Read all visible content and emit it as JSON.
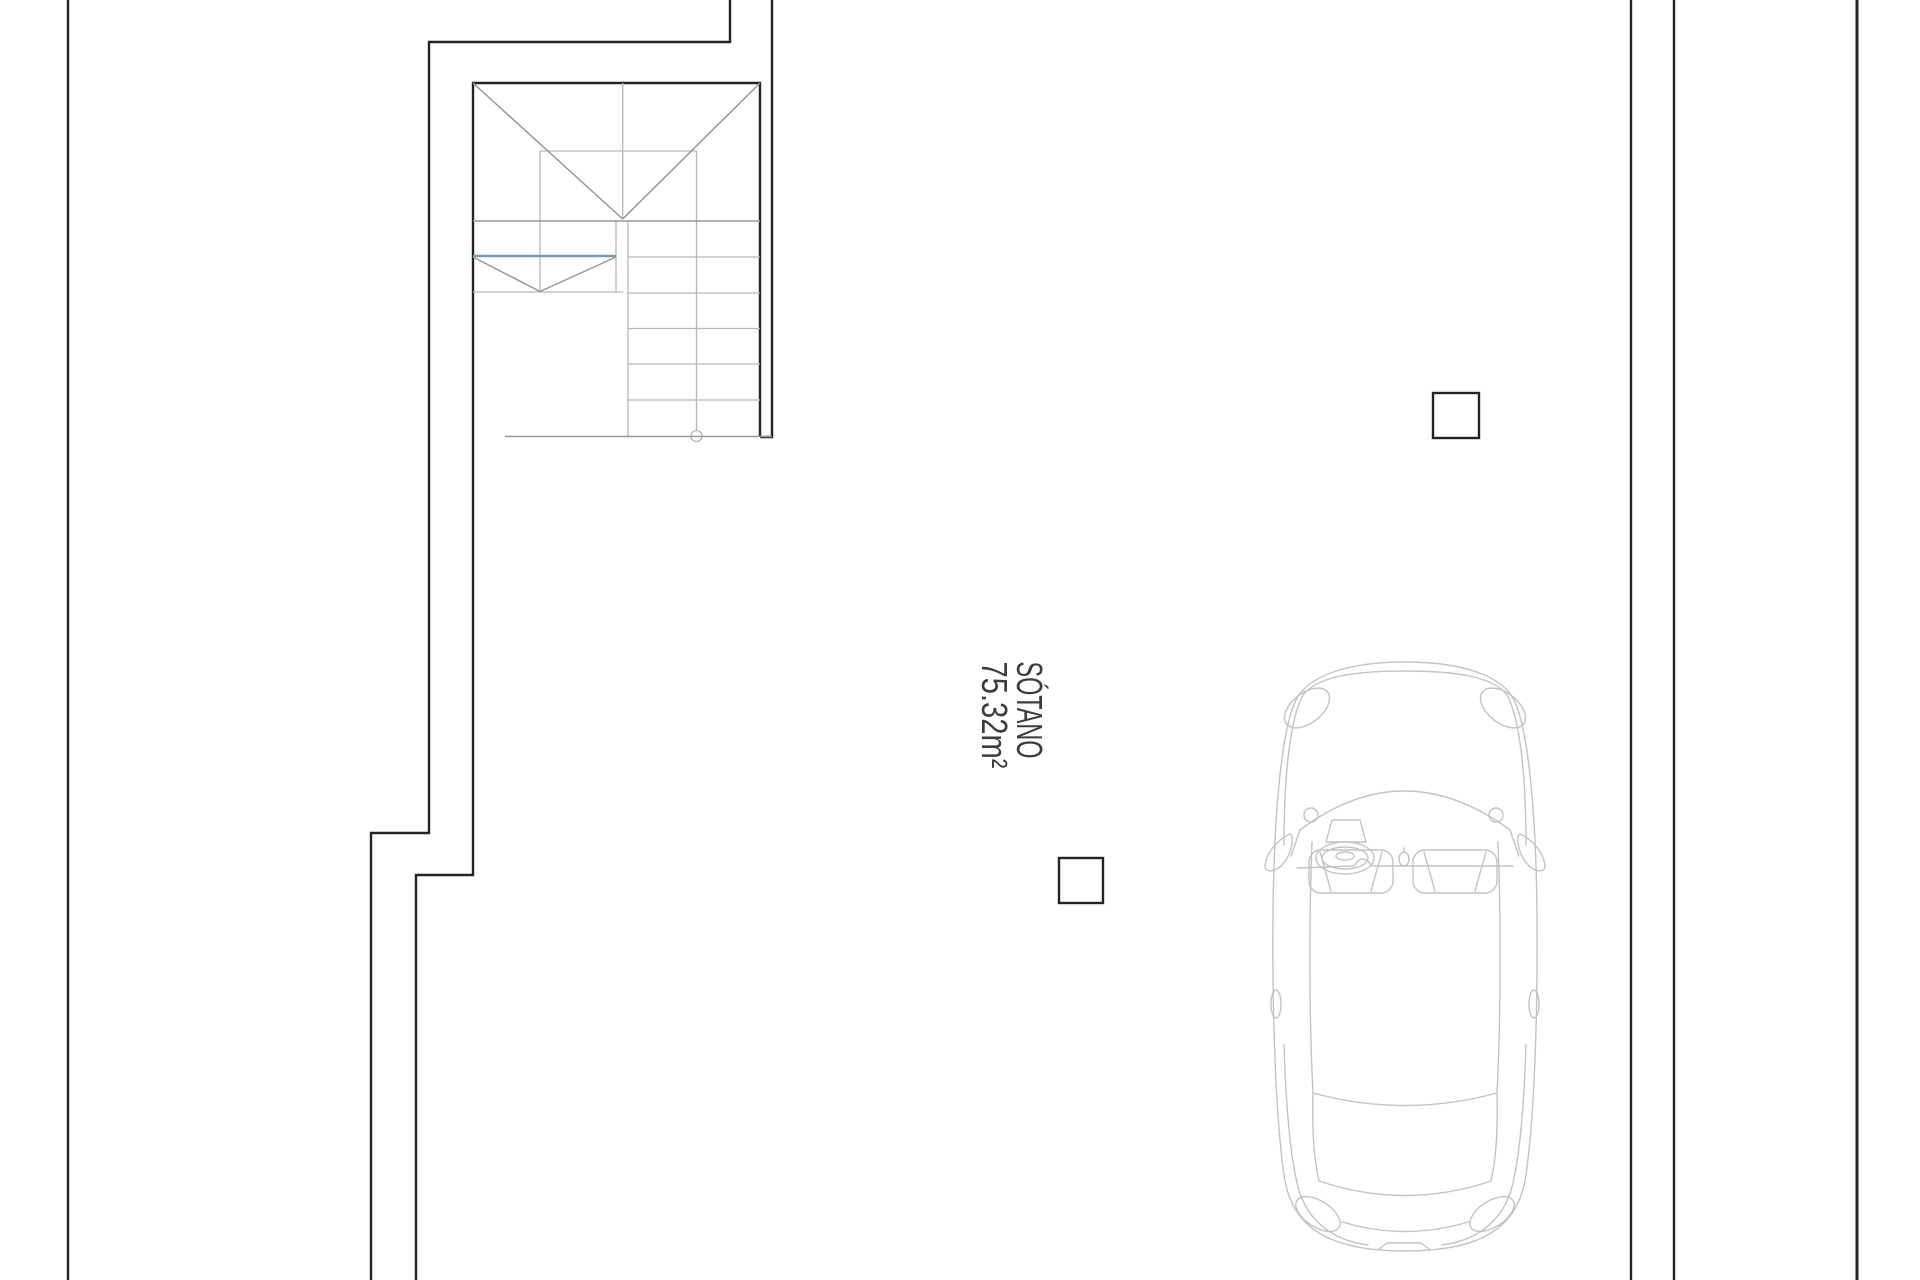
{
  "room_label": {
    "name": "SÓTANO",
    "area": "75.32m²"
  },
  "colors": {
    "background": "#ffffff",
    "wall": "#242424",
    "stair_light": "#b6b6b6",
    "stair_mid": "#979797",
    "accent_teal": "#6ba3b5",
    "car_line": "#c3c3c3",
    "text": "#3c3c3c"
  }
}
